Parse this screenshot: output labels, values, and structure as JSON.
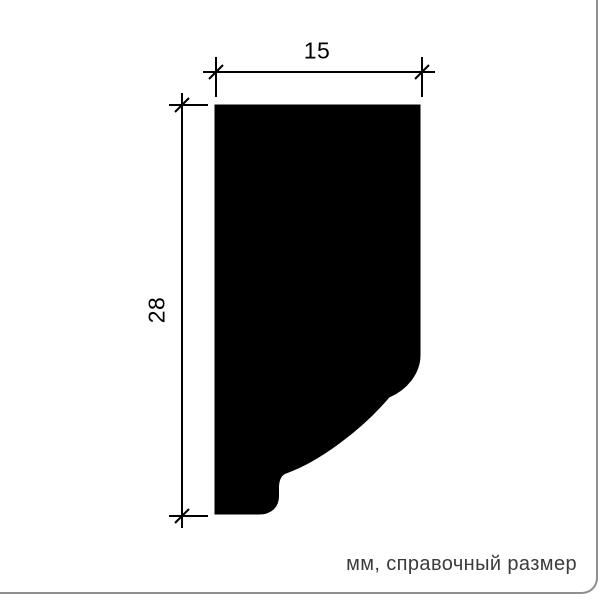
{
  "drawing": {
    "title": "molding-profile-cross-section",
    "width_dimension": {
      "label": "15",
      "value_mm": 15
    },
    "height_dimension": {
      "label": "28",
      "value_mm": 28
    },
    "note": "мм, справочный размер",
    "colors": {
      "shape_fill": "#000000",
      "dimension_line": "#000000",
      "note_text": "#3b3b3b",
      "card_border": "#8f8f8f",
      "background": "#ffffff"
    }
  }
}
